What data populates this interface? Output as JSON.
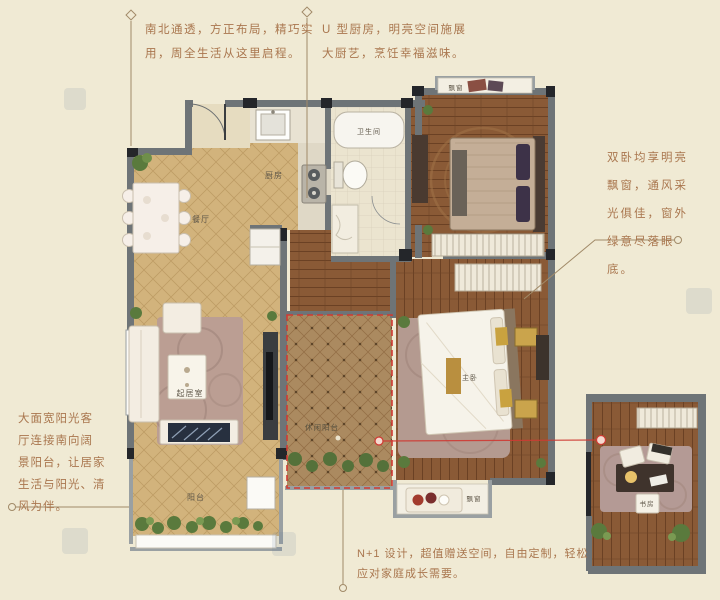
{
  "background": "#f0ead4",
  "annotations": {
    "top_left": {
      "line1": "南北通透，方正布局，精巧实",
      "line2": "用，周全生活从这里启程。"
    },
    "top_right": {
      "line1": "U 型厨房，明亮空间施展",
      "line2": "大厨艺，烹饪幸福滋味。"
    },
    "right": {
      "line1": "双卧均享明亮",
      "line2": "飘窗，通风采",
      "line3": "光俱佳，窗外",
      "line4": "绿意尽落眼",
      "line5": "底。"
    },
    "left": {
      "line1": "大面宽阳光客",
      "line2": "厅连接南向阔",
      "line3": "景阳台，让居家",
      "line4": "生活与阳光、清",
      "line5": "风为伴。"
    },
    "bottom": {
      "line1": "N+1 设计，超值赠送空间，自由定制，轻松",
      "line2": "应对家庭成长需要。"
    }
  },
  "room_labels": {
    "dining": "餐厅",
    "kitchen": "厨房",
    "bathroom": "卫生间",
    "living": "起居室",
    "master_bedroom": "主卧",
    "balcony": "阳台",
    "leisure_balcony": "休闲阳台",
    "bay_window_top": "飘窗",
    "bay_window_bottom": "飘窗",
    "study": "书房"
  },
  "colors": {
    "annotation_text": "#a9764e",
    "leader_line": "#a18a68",
    "red_accent": "#cf3a33",
    "wall": "#6e7477",
    "wood": "#8a5a36",
    "parquet": "#d2b37c"
  }
}
